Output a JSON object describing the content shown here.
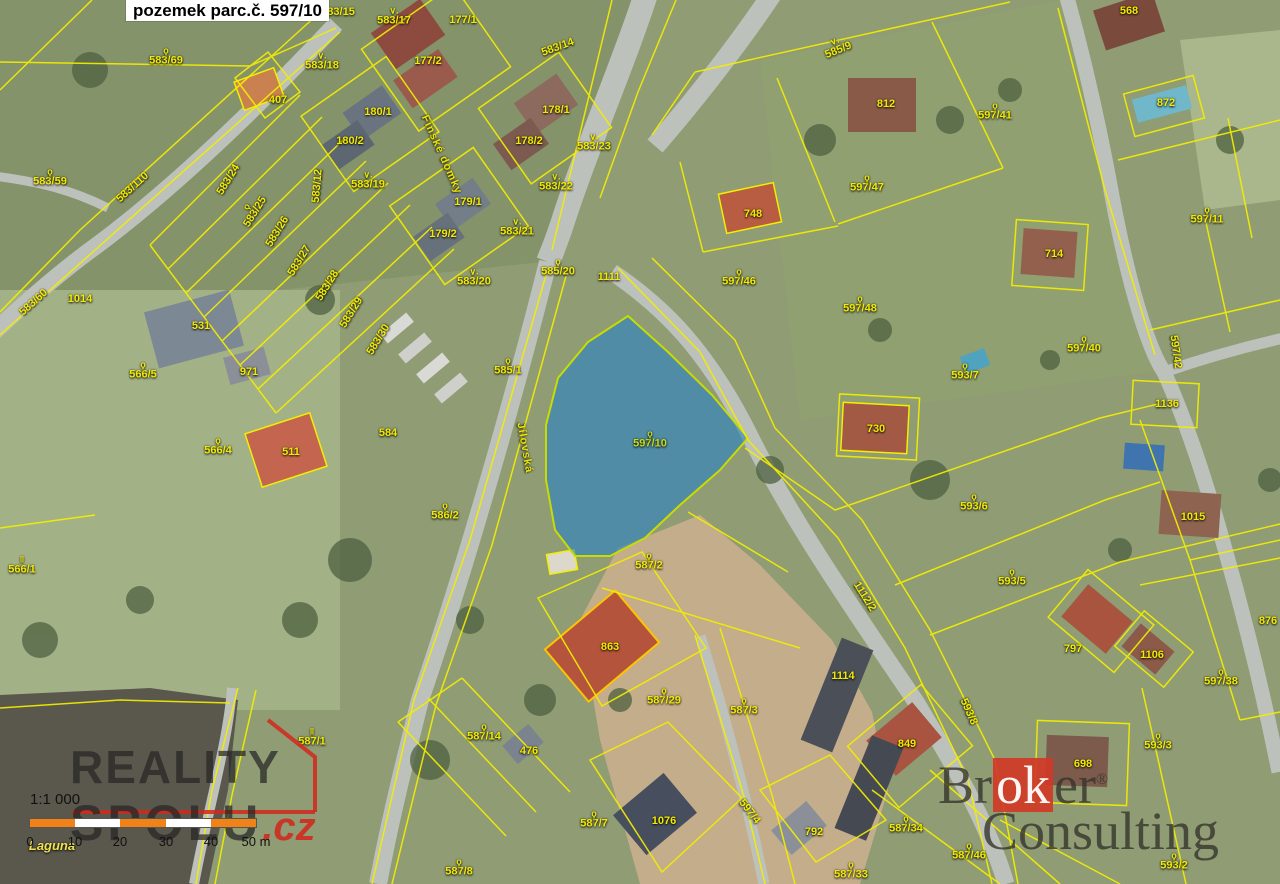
{
  "title": {
    "text": "pozemek parc.č. 597/10"
  },
  "map": {
    "highlight_parcel": "597/10",
    "highlight_color": "#2a82c3",
    "parcel_line_color": "#f4ee00",
    "symbols": {
      "q": "ϙ",
      "v": "∨.",
      "ii": "‖"
    },
    "labels": [
      {
        "t": "583/69",
        "x": 166,
        "y": 57,
        "s": "q"
      },
      {
        "t": "583/59",
        "x": 50,
        "y": 178,
        "s": "q"
      },
      {
        "t": "583/110",
        "x": 133,
        "y": 188,
        "r": -42
      },
      {
        "t": "583/60",
        "x": 34,
        "y": 303,
        "r": -42
      },
      {
        "t": "407",
        "x": 278,
        "y": 101
      },
      {
        "t": "583/24",
        "x": 229,
        "y": 180,
        "r": -58
      },
      {
        "t": "583/25",
        "x": 252,
        "y": 210,
        "r": -58,
        "s": "q"
      },
      {
        "t": "583/26",
        "x": 278,
        "y": 232,
        "r": -58
      },
      {
        "t": "583/27",
        "x": 300,
        "y": 261,
        "r": -58
      },
      {
        "t": "583/28",
        "x": 328,
        "y": 286,
        "r": -58
      },
      {
        "t": "583/29",
        "x": 352,
        "y": 313,
        "r": -58
      },
      {
        "t": "583/30",
        "x": 379,
        "y": 340,
        "r": -58
      },
      {
        "t": "583/12",
        "x": 318,
        "y": 186,
        "r": -85
      },
      {
        "t": "583/15",
        "x": 338,
        "y": 13
      },
      {
        "t": "583/17",
        "x": 394,
        "y": 17,
        "s": "v"
      },
      {
        "t": "583/18",
        "x": 322,
        "y": 62,
        "s": "v"
      },
      {
        "t": "583/19",
        "x": 368,
        "y": 181,
        "s": "v"
      },
      {
        "t": "177/1",
        "x": 463,
        "y": 21
      },
      {
        "t": "177/2",
        "x": 428,
        "y": 62
      },
      {
        "t": "583/14",
        "x": 558,
        "y": 48,
        "r": -20
      },
      {
        "t": "180/1",
        "x": 378,
        "y": 113
      },
      {
        "t": "180/2",
        "x": 350,
        "y": 142
      },
      {
        "t": "178/1",
        "x": 556,
        "y": 111
      },
      {
        "t": "178/2",
        "x": 529,
        "y": 142
      },
      {
        "t": "583/23",
        "x": 594,
        "y": 143,
        "s": "v"
      },
      {
        "t": "583/22",
        "x": 556,
        "y": 183,
        "s": "v"
      },
      {
        "t": "179/1",
        "x": 468,
        "y": 203
      },
      {
        "t": "179/2",
        "x": 443,
        "y": 235
      },
      {
        "t": "583/21",
        "x": 517,
        "y": 228,
        "s": "v"
      },
      {
        "t": "583/20",
        "x": 474,
        "y": 278,
        "s": "v"
      },
      {
        "t": "585/20",
        "x": 558,
        "y": 268,
        "s": "q"
      },
      {
        "t": "1111",
        "x": 609,
        "y": 278
      },
      {
        "t": "1014",
        "x": 80,
        "y": 300
      },
      {
        "t": "531",
        "x": 201,
        "y": 327
      },
      {
        "t": "971",
        "x": 249,
        "y": 373
      },
      {
        "t": "566/5",
        "x": 143,
        "y": 371,
        "s": "q"
      },
      {
        "t": "566/4",
        "x": 218,
        "y": 447,
        "s": "q"
      },
      {
        "t": "511",
        "x": 291,
        "y": 453
      },
      {
        "t": "584",
        "x": 388,
        "y": 434
      },
      {
        "t": "585/1",
        "x": 508,
        "y": 367,
        "s": "q"
      },
      {
        "t": "586/2",
        "x": 445,
        "y": 512,
        "s": "q"
      },
      {
        "t": "597/10",
        "x": 650,
        "y": 440,
        "s": "q",
        "cls": "hl"
      },
      {
        "t": "585/9",
        "x": 837,
        "y": 47,
        "r": -22,
        "s": "v"
      },
      {
        "t": "812",
        "x": 886,
        "y": 105
      },
      {
        "t": "597/41",
        "x": 995,
        "y": 112,
        "s": "q"
      },
      {
        "t": "597/47",
        "x": 867,
        "y": 184,
        "s": "q"
      },
      {
        "t": "748",
        "x": 753,
        "y": 215
      },
      {
        "t": "597/46",
        "x": 739,
        "y": 278,
        "s": "q"
      },
      {
        "t": "597/48",
        "x": 860,
        "y": 305,
        "s": "q"
      },
      {
        "t": "568",
        "x": 1129,
        "y": 12
      },
      {
        "t": "872",
        "x": 1166,
        "y": 104
      },
      {
        "t": "597/11",
        "x": 1207,
        "y": 216,
        "s": "q"
      },
      {
        "t": "714",
        "x": 1054,
        "y": 255
      },
      {
        "t": "597/40",
        "x": 1084,
        "y": 345,
        "s": "q"
      },
      {
        "t": "597/42",
        "x": 1175,
        "y": 352,
        "r": 82
      },
      {
        "t": "1136",
        "x": 1167,
        "y": 405
      },
      {
        "t": "730",
        "x": 876,
        "y": 430
      },
      {
        "t": "593/7",
        "x": 965,
        "y": 372,
        "s": "q"
      },
      {
        "t": "593/6",
        "x": 974,
        "y": 503,
        "s": "q"
      },
      {
        "t": "593/5",
        "x": 1012,
        "y": 578,
        "s": "q"
      },
      {
        "t": "1015",
        "x": 1193,
        "y": 518
      },
      {
        "t": "1112/2",
        "x": 864,
        "y": 597,
        "r": 58
      },
      {
        "t": "587/2",
        "x": 649,
        "y": 562,
        "s": "q"
      },
      {
        "t": "863",
        "x": 610,
        "y": 648
      },
      {
        "t": "587/29",
        "x": 664,
        "y": 697,
        "s": "q"
      },
      {
        "t": "587/3",
        "x": 744,
        "y": 707,
        "s": "q"
      },
      {
        "t": "1114",
        "x": 843,
        "y": 677
      },
      {
        "t": "476",
        "x": 529,
        "y": 752
      },
      {
        "t": "587/14",
        "x": 484,
        "y": 733,
        "s": "q"
      },
      {
        "t": "587/7",
        "x": 594,
        "y": 820,
        "s": "q"
      },
      {
        "t": "1076",
        "x": 664,
        "y": 822
      },
      {
        "t": "597/4",
        "x": 749,
        "y": 812,
        "r": 52
      },
      {
        "t": "587/8",
        "x": 459,
        "y": 868,
        "s": "q"
      },
      {
        "t": "792",
        "x": 814,
        "y": 833
      },
      {
        "t": "587/34",
        "x": 906,
        "y": 825,
        "s": "q"
      },
      {
        "t": "587/33",
        "x": 851,
        "y": 871,
        "s": "q"
      },
      {
        "t": "587/46",
        "x": 969,
        "y": 852,
        "s": "q"
      },
      {
        "t": "849",
        "x": 907,
        "y": 745
      },
      {
        "t": "698",
        "x": 1083,
        "y": 765
      },
      {
        "t": "593/8",
        "x": 968,
        "y": 712,
        "r": 66
      },
      {
        "t": "593/3",
        "x": 1158,
        "y": 742,
        "s": "q"
      },
      {
        "t": "797",
        "x": 1073,
        "y": 650
      },
      {
        "t": "1106",
        "x": 1152,
        "y": 656
      },
      {
        "t": "597/38",
        "x": 1221,
        "y": 678,
        "s": "q"
      },
      {
        "t": "876",
        "x": 1268,
        "y": 622
      },
      {
        "t": "593/2",
        "x": 1174,
        "y": 862,
        "s": "q"
      },
      {
        "t": "566/1",
        "x": 22,
        "y": 566,
        "s": "ii"
      },
      {
        "t": "587/1",
        "x": 312,
        "y": 738,
        "s": "ii"
      },
      {
        "t": "Finské domky",
        "x": 441,
        "y": 155,
        "r": 66,
        "cls": "street"
      },
      {
        "t": "Jílovská",
        "x": 524,
        "y": 448,
        "r": 80,
        "cls": "street"
      },
      {
        "t": "Laguna",
        "x": 52,
        "y": 846,
        "cls": "water"
      }
    ]
  },
  "scale": {
    "ratio": "1:1 000",
    "ticks": [
      "0",
      "10",
      "20",
      "30",
      "40",
      "50 m"
    ],
    "tick_x": [
      0,
      45,
      90,
      136,
      181,
      226
    ],
    "segment_colors": [
      "#f08218",
      "#ffffff",
      "#f08218",
      "#ffffff",
      "#f08218"
    ]
  },
  "watermarks": {
    "reality": {
      "line1": "REALITY",
      "line2": "SPOLU",
      "cz": ".cz",
      "accent": "#d5281c"
    },
    "broker": {
      "b1": "Br",
      "ok": "ok",
      "b2": "er",
      "reg": "®",
      "line2": "Consulting",
      "accent": "#d03a26"
    }
  }
}
